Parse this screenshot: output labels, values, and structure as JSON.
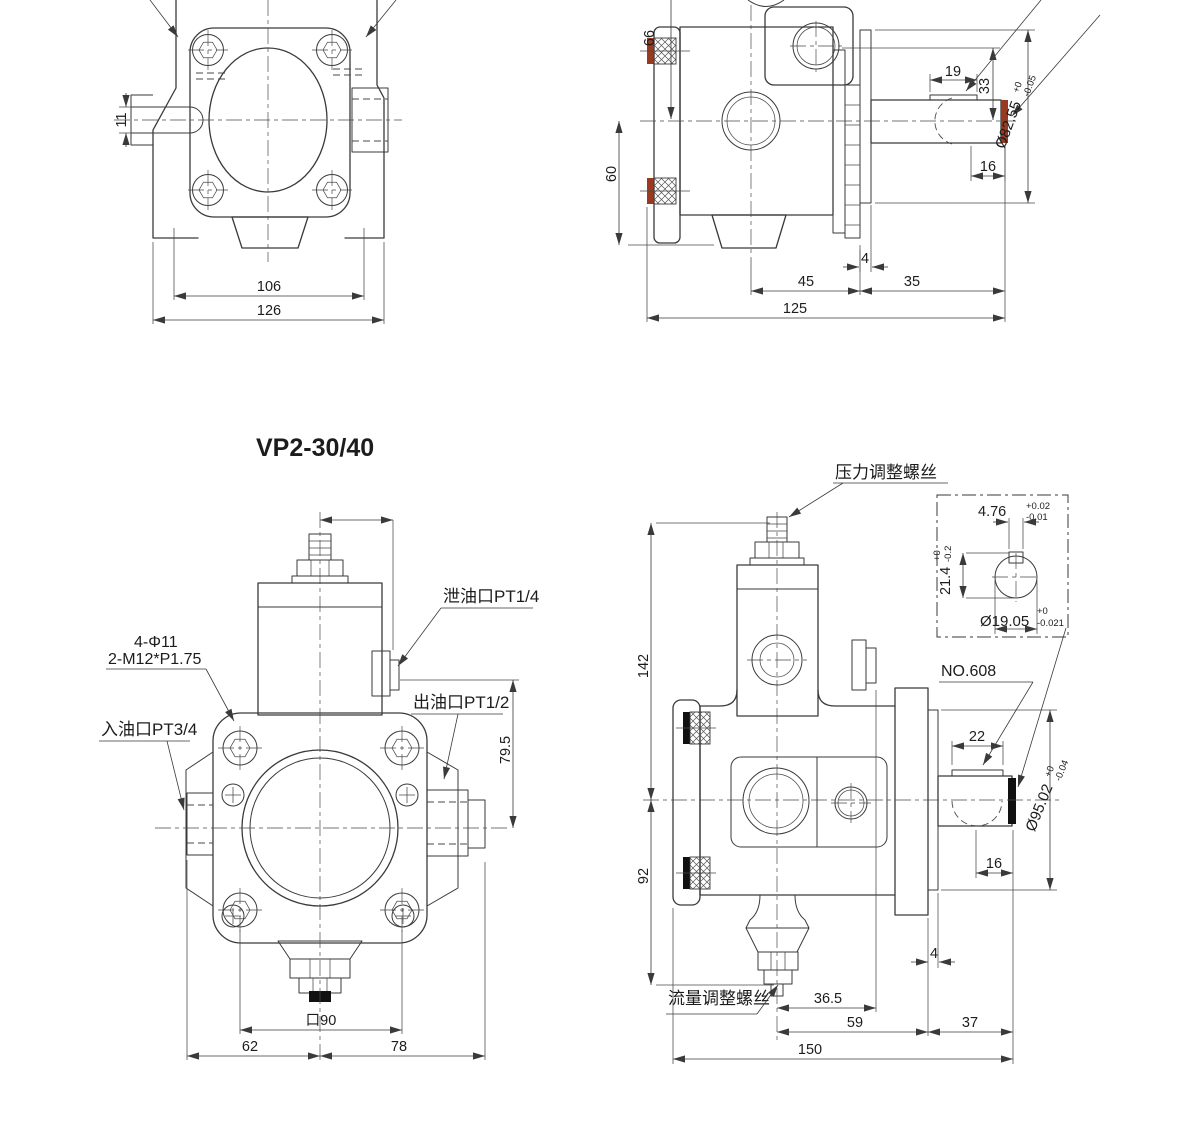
{
  "title": "VP2-30/40",
  "colors": {
    "line": "#3a3a3a",
    "seal": "#993a20",
    "cap": "#111111"
  },
  "views": {
    "front_small": {
      "d11": "11",
      "d106": "106",
      "d126": "126"
    },
    "side_small": {
      "d66": "66",
      "d60": "60",
      "d19": "19",
      "d33": "33",
      "d16": "16",
      "d4": "4",
      "d45": "45",
      "d35": "35",
      "d125": "125",
      "dia": "Ø82.55",
      "dia_up": "+0",
      "dia_dn": "-0.05"
    },
    "front_large": {
      "holes": "4-Φ11",
      "thread": "2-M12*P1.75",
      "inlet": "入油口PT3/4",
      "drain": "泄油口PT1/4",
      "outlet": "出油口PT1/2",
      "d79_5": "79.5",
      "sq90": "口90",
      "d62": "62",
      "d78": "78"
    },
    "side_large": {
      "pressure_screw": "压力调整螺丝",
      "flow_screw": "流量调整螺丝",
      "bearing": "NO.608",
      "d142": "142",
      "d92": "92",
      "d22": "22",
      "d16": "16",
      "d4": "4",
      "d36_5": "36.5",
      "d59": "59",
      "d37": "37",
      "d150": "150",
      "dia": "Ø95.02",
      "dia_up": "+0",
      "dia_dn": "-0.04",
      "key_detail": {
        "w": "4.76",
        "w_up": "+0.02",
        "w_dn": "-0.01",
        "h": "21.4",
        "h_up": "+0",
        "h_dn": "-0.2",
        "dia": "Ø19.05",
        "dia_up": "+0",
        "dia_dn": "-0.021"
      }
    }
  }
}
